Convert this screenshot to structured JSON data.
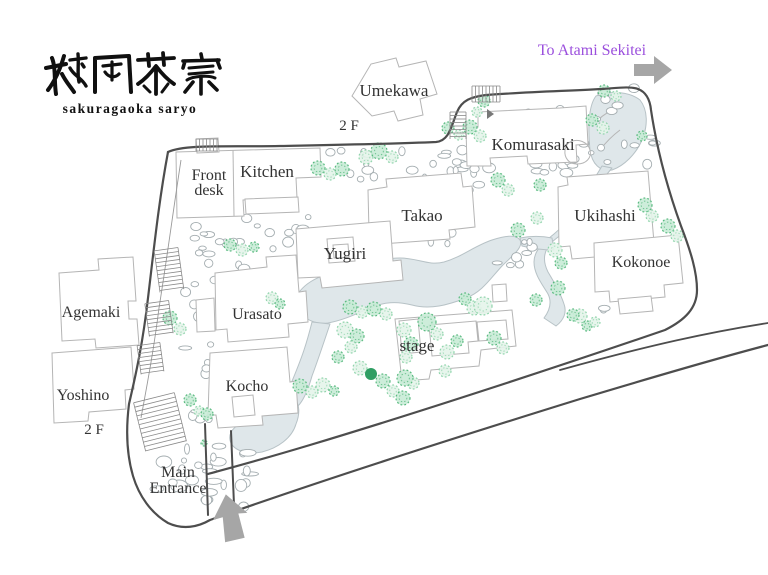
{
  "colors": {
    "purple": "#9b4fdd",
    "arrow_gray": "#a6a6a6",
    "boundary": "#4d4d4d",
    "building_stroke": "#b5b5b5",
    "water_fill": "#dfe7ea",
    "water_stroke": "#b7c2c6",
    "tree_light": "#8fd4ab",
    "tree_medium": "#57b97e",
    "tree_dark": "#2f9e63",
    "label_text": "#333333"
  },
  "logo": {
    "kanji": "桜岡茶寮",
    "romaji": "sakuragaoka saryo"
  },
  "direction_sign": {
    "label": "To Atami Sekitei"
  },
  "map": {
    "labels": [
      {
        "id": "label-umekawa",
        "text": "Umekawa",
        "x": 394,
        "y": 96,
        "size": 17
      },
      {
        "id": "label-umekawa-floor",
        "text": "2 F",
        "x": 349,
        "y": 130,
        "size": 15
      },
      {
        "id": "label-komurasaki",
        "text": "Komurasaki",
        "x": 533,
        "y": 150,
        "size": 17
      },
      {
        "id": "label-front-desk",
        "lines": [
          "Front",
          "desk"
        ],
        "x": 209,
        "y": 180,
        "size": 16,
        "lh": 15
      },
      {
        "id": "label-kitchen",
        "text": "Kitchen",
        "x": 267,
        "y": 177,
        "size": 17
      },
      {
        "id": "label-takao",
        "text": "Takao",
        "x": 422,
        "y": 221,
        "size": 17
      },
      {
        "id": "label-yugiri",
        "text": "Yugiri",
        "x": 345,
        "y": 259,
        "size": 17
      },
      {
        "id": "label-ukihashi",
        "text": "Ukihashi",
        "x": 605,
        "y": 221,
        "size": 17
      },
      {
        "id": "label-kokonoe",
        "text": "Kokonoe",
        "x": 641,
        "y": 267,
        "size": 16
      },
      {
        "id": "label-urasato",
        "text": "Urasato",
        "x": 257,
        "y": 319,
        "size": 16
      },
      {
        "id": "label-kocho",
        "text": "Kocho",
        "x": 247,
        "y": 391,
        "size": 16
      },
      {
        "id": "label-stage",
        "text": "stage",
        "x": 417,
        "y": 351,
        "size": 17
      },
      {
        "id": "label-agemaki",
        "text": "Agemaki",
        "x": 91,
        "y": 317,
        "size": 16
      },
      {
        "id": "label-yoshino",
        "text": "Yoshino",
        "x": 83,
        "y": 400,
        "size": 16
      },
      {
        "id": "label-yoshino-floor",
        "text": "2 F",
        "x": 94,
        "y": 434,
        "size": 15
      },
      {
        "id": "label-main-entrance",
        "lines": [
          "Main",
          "Entrance"
        ],
        "x": 178,
        "y": 477,
        "size": 16,
        "lh": 16
      },
      {
        "id": "label-to-atami",
        "text": "To Atami Sekitei",
        "x": 592,
        "y": 55,
        "size": 16,
        "cls": "purple"
      }
    ],
    "trees": [
      [
        318,
        168,
        7,
        "M"
      ],
      [
        330,
        174,
        6,
        "L"
      ],
      [
        342,
        169,
        7,
        "M"
      ],
      [
        366,
        157,
        7,
        "L"
      ],
      [
        379,
        151,
        8,
        "M"
      ],
      [
        392,
        157,
        6,
        "L"
      ],
      [
        448,
        128,
        6,
        "M"
      ],
      [
        459,
        135,
        5,
        "L"
      ],
      [
        484,
        101,
        6,
        "M"
      ],
      [
        477,
        112,
        5,
        "L"
      ],
      [
        470,
        127,
        7,
        "M"
      ],
      [
        480,
        136,
        6,
        "L"
      ],
      [
        604,
        91,
        6,
        "M"
      ],
      [
        616,
        96,
        5,
        "L"
      ],
      [
        592,
        120,
        6,
        "M"
      ],
      [
        603,
        128,
        6,
        "L"
      ],
      [
        642,
        136,
        5,
        "M"
      ],
      [
        498,
        180,
        7,
        "M"
      ],
      [
        508,
        190,
        6,
        "L"
      ],
      [
        540,
        185,
        6,
        "M"
      ],
      [
        537,
        218,
        6,
        "L"
      ],
      [
        518,
        230,
        7,
        "M"
      ],
      [
        555,
        250,
        7,
        "L"
      ],
      [
        561,
        263,
        6,
        "M"
      ],
      [
        645,
        205,
        7,
        "M"
      ],
      [
        652,
        216,
        6,
        "L"
      ],
      [
        668,
        226,
        7,
        "M"
      ],
      [
        677,
        236,
        6,
        "L"
      ],
      [
        230,
        245,
        6,
        "M"
      ],
      [
        242,
        250,
        6,
        "L"
      ],
      [
        254,
        247,
        5,
        "M"
      ],
      [
        272,
        298,
        6,
        "L"
      ],
      [
        280,
        304,
        5,
        "M"
      ],
      [
        170,
        318,
        7,
        "M"
      ],
      [
        180,
        329,
        6,
        "L"
      ],
      [
        190,
        400,
        6,
        "M"
      ],
      [
        199,
        411,
        5,
        "L"
      ],
      [
        207,
        414,
        6,
        "M"
      ],
      [
        204,
        443,
        3,
        "M"
      ],
      [
        300,
        386,
        7,
        "M"
      ],
      [
        312,
        392,
        6,
        "L"
      ],
      [
        323,
        385,
        7,
        "L"
      ],
      [
        334,
        391,
        5,
        "M"
      ],
      [
        350,
        307,
        7,
        "M"
      ],
      [
        362,
        312,
        6,
        "L"
      ],
      [
        374,
        309,
        7,
        "M"
      ],
      [
        386,
        314,
        6,
        "L"
      ],
      [
        404,
        330,
        7,
        "L"
      ],
      [
        411,
        344,
        7,
        "M"
      ],
      [
        406,
        357,
        6,
        "L"
      ],
      [
        345,
        330,
        8,
        "L"
      ],
      [
        357,
        336,
        7,
        "M"
      ],
      [
        351,
        347,
        6,
        "L"
      ],
      [
        338,
        357,
        6,
        "M"
      ],
      [
        360,
        368,
        7,
        "L"
      ],
      [
        371,
        374,
        6,
        "D"
      ],
      [
        383,
        381,
        7,
        "M"
      ],
      [
        393,
        391,
        6,
        "L"
      ],
      [
        403,
        398,
        7,
        "M"
      ],
      [
        413,
        383,
        6,
        "L"
      ],
      [
        427,
        322,
        9,
        "M"
      ],
      [
        437,
        334,
        6,
        "L"
      ],
      [
        447,
        352,
        7,
        "L"
      ],
      [
        457,
        341,
        6,
        "M"
      ],
      [
        465,
        299,
        6,
        "M"
      ],
      [
        474,
        308,
        7,
        "L"
      ],
      [
        483,
        306,
        9,
        "L"
      ],
      [
        494,
        338,
        7,
        "M"
      ],
      [
        503,
        348,
        6,
        "L"
      ],
      [
        536,
        300,
        6,
        "M"
      ],
      [
        558,
        288,
        7,
        "M"
      ],
      [
        580,
        316,
        7,
        "L"
      ],
      [
        587,
        326,
        5,
        "M"
      ],
      [
        573,
        315,
        6,
        "M"
      ],
      [
        595,
        322,
        5,
        "L"
      ],
      [
        405,
        378,
        8,
        "M"
      ],
      [
        445,
        371,
        6,
        "L"
      ]
    ]
  }
}
